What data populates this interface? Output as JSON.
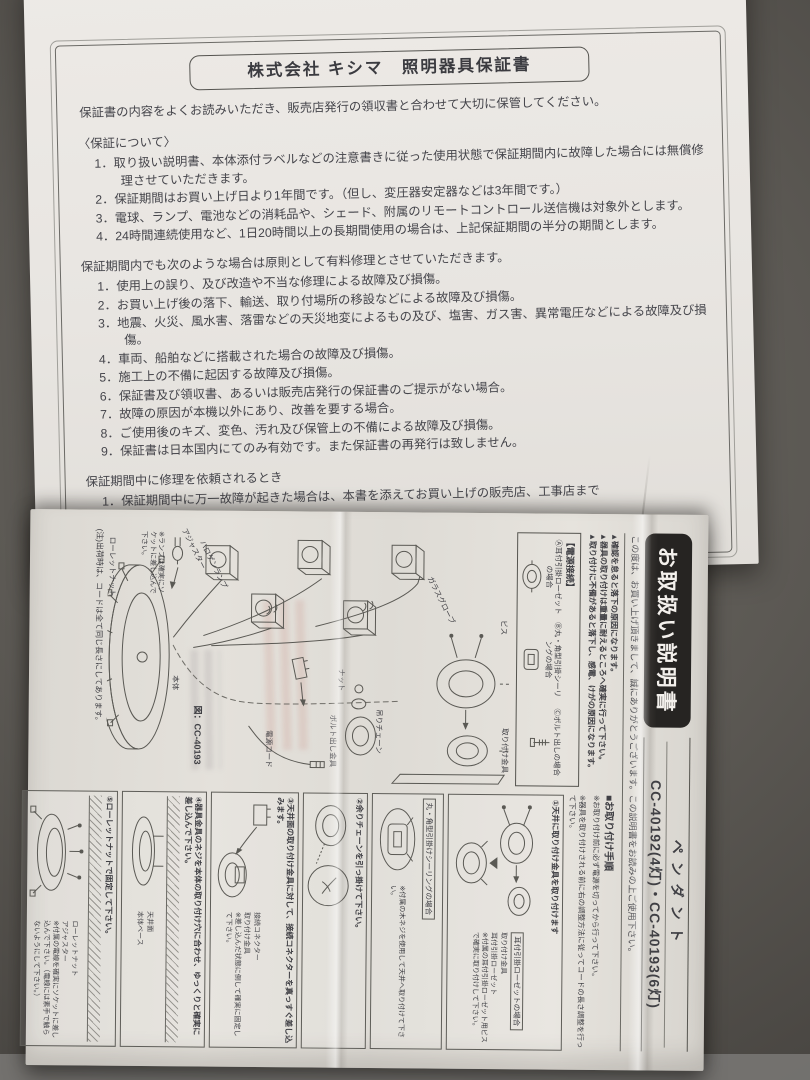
{
  "warranty": {
    "title": "株式会社 キシマ　照明器具保証書",
    "intro": "保証書の内容をよくお読みいただき、販売店発行の領収書と合わせて大切に保管してください。",
    "about": {
      "heading": "〈保証について〉",
      "items": [
        "1．取り扱い説明書、本体添付ラベルなどの注意書きに従った使用状態で保証期間内に故障した場合には無償修理させていただきます。",
        "2．保証期間はお買い上げ日より1年間です。（但し、変圧器安定器などは3年間です。）",
        "3．電球、ランプ、電池などの消耗品や、シェード、附属のリモートコントロール送信機は対象外とします。",
        "4．24時間連続使用など、1日20時間以上の長期間使用の場合は、上記保証期間の半分の期間とします。"
      ]
    },
    "paid": {
      "heading": "保証期間内でも次のような場合は原則として有料修理とさせていただきます。",
      "items": [
        "1．使用上の誤り、及び改造や不当な修理による故障及び損傷。",
        "2．お買い上げ後の落下、輸送、取り付場所の移設などによる故障及び損傷。",
        "3．地震、火災、風水害、落雷などの天災地変によるもの及び、塩害、ガス害、異常電圧などによる故障及び損傷。",
        "4．車両、船舶などに搭載された場合の故障及び損傷。",
        "5．施工上の不備に起因する故障及び損傷。",
        "6．保証書及び領収書、あるいは販売店発行の保証書のご提示がない場合。",
        "7．故障の原因が本機以外にあり、改善を要する場合。",
        "8．ご使用後のキズ、変色、汚れ及び保管上の不備による故障及び損傷。",
        "9．保証書は日本国内にてのみ有効です。また保証書の再発行は致しません。"
      ]
    },
    "request": {
      "heading": "保証期間中に修理を依頼されるとき",
      "item": "1．保証期間中に万一故障が起きた場合は、本書を添えてお買い上げの販売店、工事店まで"
    }
  },
  "manual": {
    "badge": "お取扱い説明書",
    "product": "ペンダント",
    "models": "CC-40192(4灯)・CC-40193(6灯)",
    "greeting": "この度は、お買い上げ頂きまして、誠にありがとうございます。この説明書をお読みの上ご使用下さい。",
    "warnings": [
      "▲確認を怠ると落下の原因になります。",
      "▲器具の取り付けは重量に耐えるところへ確実に行って下さい。",
      "▲取り付けに不備があると落下し、感電、けがの原因になります。"
    ],
    "power": {
      "heading": "【電源接続】",
      "options": [
        "Ⓐ耳付引掛ローゼットの場合",
        "Ⓑ丸・角型引掛シーリングの場合",
        "Ⓒボルト出しの場合"
      ]
    },
    "diagram": {
      "labels": {
        "screw": "ビス",
        "bracket": "取り付け金具",
        "glass": "ガラスグローブ",
        "chain": "吊りチェーン",
        "nut": "ナット",
        "bolt": "ボルト出し金具",
        "cord": "電源コード",
        "body": "本体",
        "adjuster": "アジャスター",
        "halogen": "ハロゲンランプ",
        "knurled": "ローレットナット"
      },
      "lamp_note": "※ランプは確実にソケットに差し込んで下さい。",
      "figure": "図：CC-40193",
      "note": "(注)出荷時は、コードは全て同じ長さにしてあります。"
    },
    "steps": {
      "heading": "■お取り付け手順",
      "note1": "※お取り付け前に必ず電源を切ってから行って下さい。",
      "note2": "※器具を取り付けされる前に右の調整方法に従ってコードの長さ調整を行って下さい。",
      "panels": {
        "p1": {
          "title": "①天井に取り付け金具を取り付けます",
          "variant": "耳付引掛ローゼットの場合",
          "note": "※付属の耳付引掛ローゼット用ビスで確実に取り付けして下さい。",
          "label1": "取り付け金具",
          "label2": "耳付引掛ローゼット"
        },
        "p2": {
          "variant": "丸・角型引掛けシーリングの場合",
          "note": "※付属の木ネジを使用して天井へ取り付けて下さい。"
        },
        "p3": {
          "title": "②余りチェーンを引っ掛けて下さい。"
        },
        "p4": {
          "title": "③天井面の取り付け金具に対して、接続コネクターを真っすぐ差し込みます。",
          "note": "※差し込んだ状態に倒して確実に固定して下さい。",
          "label1": "接続コネクター",
          "label2": "取り付け金具"
        },
        "p5": {
          "title": "④器具金具のネジを本体の取り付け穴に合わせ、ゆっくりと確実に差し込んで下さい。",
          "label1": "本体ベース",
          "label2": "天井面"
        },
        "p6": {
          "title": "⑤ローレットナットで固定して下さい。",
          "note": "※付属の電線を確実にソケットに差し込んで下さい。（電線には素手で触らないようにして下さい。）",
          "label1": "ローレットナット",
          "label2": "アジャスター"
        }
      }
    }
  }
}
